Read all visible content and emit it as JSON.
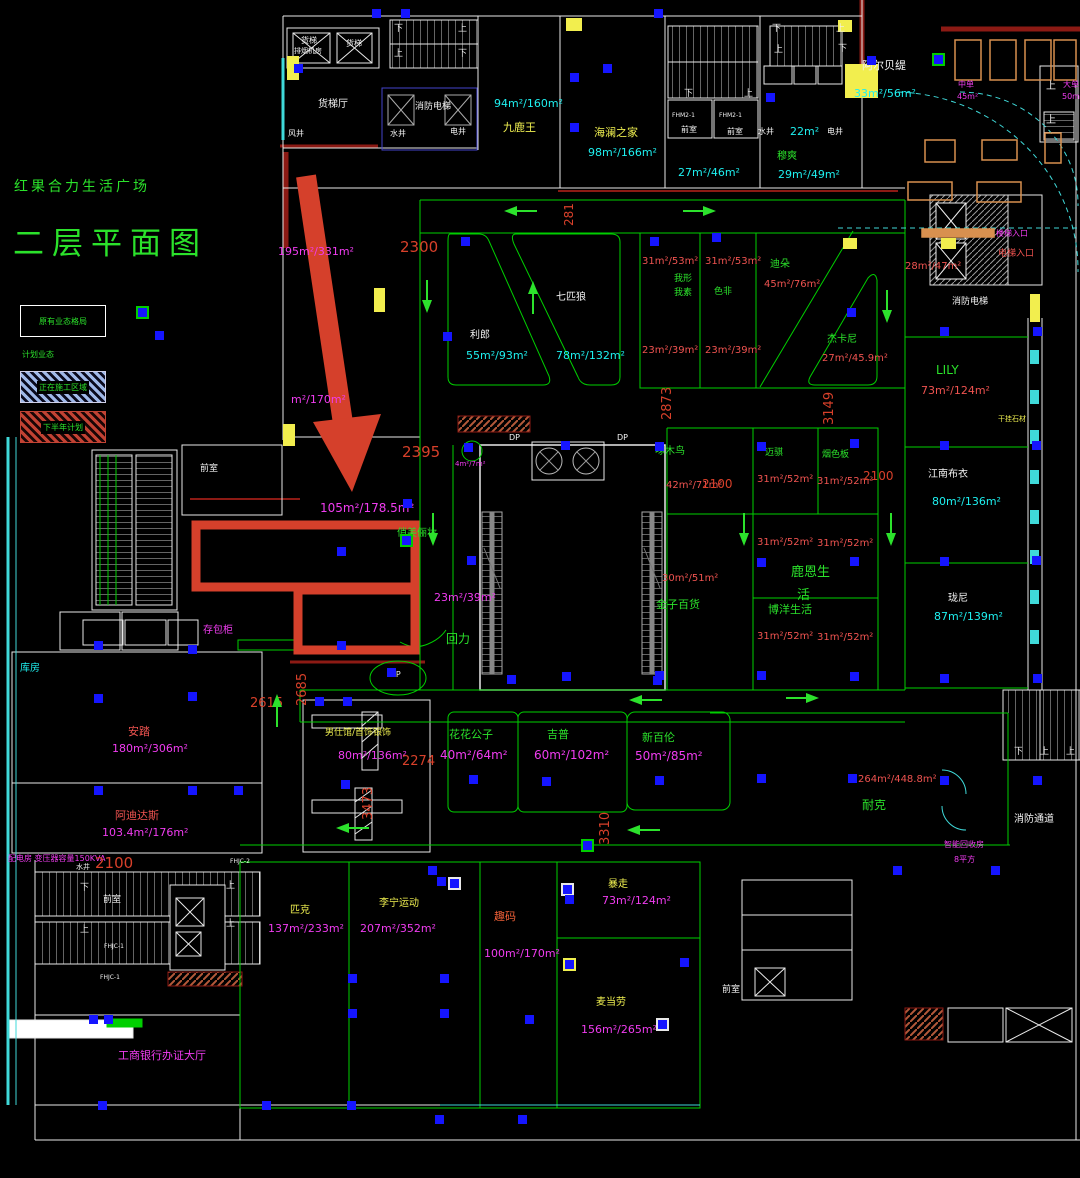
{
  "title": {
    "line1": "红果合力生活广场",
    "line2": "二层平面图"
  },
  "legend": {
    "existing": "原有业态格局",
    "planned": "计划业态",
    "construction": "正在施工区域",
    "second_half": "下半年计划"
  },
  "colors": {
    "g": "#2be22b",
    "c": "#1ef0f0",
    "m": "#f03cf0",
    "r": "#ef5350",
    "y": "#f0f050",
    "w": "#f2f2f2",
    "o": "#f06038",
    "d": "#d8402a"
  },
  "labels": [
    {
      "t": "货梯",
      "x": 301,
      "y": 37,
      "c": "w",
      "s": 8
    },
    {
      "t": "排烟机房",
      "x": 294,
      "y": 48,
      "c": "w",
      "s": 7
    },
    {
      "t": "货梯",
      "x": 346,
      "y": 40,
      "c": "w",
      "s": 8
    },
    {
      "t": "货梯厅",
      "x": 318,
      "y": 100,
      "c": "w",
      "s": 10
    },
    {
      "t": "风井",
      "x": 288,
      "y": 130,
      "c": "w",
      "s": 8
    },
    {
      "t": "水井",
      "x": 390,
      "y": 130,
      "c": "w",
      "s": 8
    },
    {
      "t": "电井",
      "x": 450,
      "y": 128,
      "c": "w",
      "s": 8
    },
    {
      "t": "消防电梯",
      "x": 415,
      "y": 103,
      "c": "w",
      "s": 9
    },
    {
      "t": "下",
      "x": 394,
      "y": 25,
      "c": "w",
      "s": 9
    },
    {
      "t": "上",
      "x": 458,
      "y": 25,
      "c": "w",
      "s": 9
    },
    {
      "t": "上",
      "x": 394,
      "y": 50,
      "c": "w",
      "s": 9
    },
    {
      "t": "下",
      "x": 458,
      "y": 50,
      "c": "w",
      "s": 9
    },
    {
      "t": "94m²/160m²",
      "x": 494,
      "y": 98,
      "c": "c",
      "s": 11
    },
    {
      "t": "九鹿王",
      "x": 503,
      "y": 122,
      "c": "y",
      "s": 11
    },
    {
      "t": "海澜之家",
      "x": 594,
      "y": 127,
      "c": "y",
      "s": 11
    },
    {
      "t": "98m²/166m²",
      "x": 588,
      "y": 147,
      "c": "c",
      "s": 11
    },
    {
      "t": "27m²/46m²",
      "x": 678,
      "y": 167,
      "c": "c",
      "s": 11
    },
    {
      "t": "下",
      "x": 684,
      "y": 90,
      "c": "w",
      "s": 9
    },
    {
      "t": "上",
      "x": 744,
      "y": 90,
      "c": "w",
      "s": 9
    },
    {
      "t": "前室",
      "x": 681,
      "y": 126,
      "c": "w",
      "s": 8
    },
    {
      "t": "前室",
      "x": 727,
      "y": 128,
      "c": "w",
      "s": 8
    },
    {
      "t": "FHM2-1",
      "x": 672,
      "y": 113,
      "c": "w",
      "s": 6
    },
    {
      "t": "FHM2-1",
      "x": 719,
      "y": 113,
      "c": "w",
      "s": 6
    },
    {
      "t": "水井",
      "x": 758,
      "y": 128,
      "c": "w",
      "s": 8
    },
    {
      "t": "22m²",
      "x": 790,
      "y": 126,
      "c": "c",
      "s": 11
    },
    {
      "t": "电井",
      "x": 827,
      "y": 128,
      "c": "w",
      "s": 8
    },
    {
      "t": "下",
      "x": 772,
      "y": 25,
      "c": "w",
      "s": 9
    },
    {
      "t": "上",
      "x": 836,
      "y": 25,
      "c": "w",
      "s": 9
    },
    {
      "t": "上",
      "x": 774,
      "y": 46,
      "c": "w",
      "s": 9
    },
    {
      "t": "下",
      "x": 838,
      "y": 45,
      "c": "w",
      "s": 9
    },
    {
      "t": "穆爽",
      "x": 777,
      "y": 152,
      "c": "g",
      "s": 10
    },
    {
      "t": "29m²/49m²",
      "x": 778,
      "y": 169,
      "c": "c",
      "s": 11
    },
    {
      "t": "阿尔贝缇",
      "x": 862,
      "y": 60,
      "c": "w",
      "s": 11
    },
    {
      "t": "33m²/56m²",
      "x": 854,
      "y": 88,
      "c": "c",
      "s": 11
    },
    {
      "t": "中单",
      "x": 958,
      "y": 81,
      "c": "m",
      "s": 8
    },
    {
      "t": "45m²",
      "x": 957,
      "y": 93,
      "c": "m",
      "s": 8
    },
    {
      "t": "大单",
      "x": 1063,
      "y": 81,
      "c": "m",
      "s": 8
    },
    {
      "t": "50m²",
      "x": 1062,
      "y": 93,
      "c": "m",
      "s": 8
    },
    {
      "t": "上",
      "x": 1046,
      "y": 82,
      "c": "w",
      "s": 10
    },
    {
      "t": "上",
      "x": 1046,
      "y": 116,
      "c": "w",
      "s": 10
    },
    {
      "t": "195m²/331m²",
      "x": 278,
      "y": 246,
      "c": "m",
      "s": 11
    },
    {
      "t": "m²/170m²",
      "x": 291,
      "y": 394,
      "c": "m",
      "s": 11
    },
    {
      "t": "前室",
      "x": 200,
      "y": 465,
      "c": "w",
      "s": 9
    },
    {
      "t": "105m²/178.5m²",
      "x": 320,
      "y": 502,
      "c": "m",
      "s": 12
    },
    {
      "t": "俏美俪妆",
      "x": 397,
      "y": 529,
      "c": "g",
      "s": 10
    },
    {
      "t": "4m²/7m²",
      "x": 455,
      "y": 461,
      "c": "m",
      "s": 7
    },
    {
      "t": "23m²/39m²",
      "x": 434,
      "y": 592,
      "c": "m",
      "s": 11
    },
    {
      "t": "回力",
      "x": 446,
      "y": 633,
      "c": "g",
      "s": 12
    },
    {
      "t": "存包柜",
      "x": 203,
      "y": 626,
      "c": "m",
      "s": 10
    },
    {
      "t": "库房",
      "x": 20,
      "y": 664,
      "c": "c",
      "s": 10
    },
    {
      "t": "安踏",
      "x": 128,
      "y": 726,
      "c": "r",
      "s": 11
    },
    {
      "t": "180m²/306m²",
      "x": 112,
      "y": 743,
      "c": "m",
      "s": 11
    },
    {
      "t": "阿迪达斯",
      "x": 115,
      "y": 810,
      "c": "r",
      "s": 11
    },
    {
      "t": "103.4m²/176m²",
      "x": 102,
      "y": 827,
      "c": "m",
      "s": 11
    },
    {
      "t": "配电房 变压器容量150KVA",
      "x": 8,
      "y": 855,
      "c": "m",
      "s": 8
    },
    {
      "t": "利郎",
      "x": 470,
      "y": 331,
      "c": "w",
      "s": 10
    },
    {
      "t": "55m²/93m²",
      "x": 466,
      "y": 350,
      "c": "c",
      "s": 11
    },
    {
      "t": "七匹狼",
      "x": 556,
      "y": 293,
      "c": "w",
      "s": 10
    },
    {
      "t": "78m²/132m²",
      "x": 556,
      "y": 350,
      "c": "c",
      "s": 11
    },
    {
      "t": "31m²/53m²",
      "x": 642,
      "y": 257,
      "c": "r",
      "s": 10
    },
    {
      "t": "我形",
      "x": 674,
      "y": 275,
      "c": "g",
      "s": 9
    },
    {
      "t": "我素",
      "x": 674,
      "y": 289,
      "c": "g",
      "s": 9
    },
    {
      "t": "23m²/39m²",
      "x": 642,
      "y": 346,
      "c": "r",
      "s": 10
    },
    {
      "t": "31m²/53m²",
      "x": 705,
      "y": 257,
      "c": "r",
      "s": 10
    },
    {
      "t": "色非",
      "x": 714,
      "y": 288,
      "c": "g",
      "s": 9
    },
    {
      "t": "23m²/39m²",
      "x": 705,
      "y": 346,
      "c": "r",
      "s": 10
    },
    {
      "t": "迪朵",
      "x": 770,
      "y": 260,
      "c": "g",
      "s": 10
    },
    {
      "t": "45m²/76m²",
      "x": 764,
      "y": 280,
      "c": "r",
      "s": 10
    },
    {
      "t": "杰卡尼",
      "x": 827,
      "y": 335,
      "c": "g",
      "s": 10
    },
    {
      "t": "27m²/45.9m²",
      "x": 822,
      "y": 354,
      "c": "r",
      "s": 10
    },
    {
      "t": "28m²/47m²",
      "x": 905,
      "y": 262,
      "c": "r",
      "s": 10
    },
    {
      "t": "楼梯入口",
      "x": 996,
      "y": 230,
      "c": "m",
      "s": 8
    },
    {
      "t": "电梯入口",
      "x": 998,
      "y": 250,
      "c": "r",
      "s": 9
    },
    {
      "t": "消防电梯",
      "x": 952,
      "y": 298,
      "c": "w",
      "s": 9
    },
    {
      "t": "干挂石材",
      "x": 998,
      "y": 416,
      "c": "y",
      "s": 7
    },
    {
      "t": "LILY",
      "x": 936,
      "y": 364,
      "c": "g",
      "s": 12
    },
    {
      "t": "73m²/124m²",
      "x": 921,
      "y": 385,
      "c": "r",
      "s": 11
    },
    {
      "t": "江南布衣",
      "x": 928,
      "y": 470,
      "c": "w",
      "s": 10
    },
    {
      "t": "80m²/136m²",
      "x": 932,
      "y": 496,
      "c": "c",
      "s": 11
    },
    {
      "t": "珑尼",
      "x": 948,
      "y": 594,
      "c": "w",
      "s": 10
    },
    {
      "t": "87m²/139m²",
      "x": 934,
      "y": 611,
      "c": "c",
      "s": 11
    },
    {
      "t": "DP",
      "x": 509,
      "y": 434,
      "c": "w",
      "s": 8
    },
    {
      "t": "DP",
      "x": 617,
      "y": 434,
      "c": "w",
      "s": 8
    },
    {
      "t": "啄木鸟",
      "x": 655,
      "y": 447,
      "c": "g",
      "s": 10
    },
    {
      "t": "42m²/71m²",
      "x": 666,
      "y": 481,
      "c": "r",
      "s": 10
    },
    {
      "t": "30m²/51m²",
      "x": 662,
      "y": 574,
      "c": "r",
      "s": 10
    },
    {
      "t": "金子百货",
      "x": 656,
      "y": 599,
      "c": "g",
      "s": 11
    },
    {
      "t": "迈骐",
      "x": 765,
      "y": 449,
      "c": "g",
      "s": 9
    },
    {
      "t": "31m²/52m²",
      "x": 757,
      "y": 475,
      "c": "r",
      "s": 10
    },
    {
      "t": "烟色板",
      "x": 822,
      "y": 451,
      "c": "g",
      "s": 9
    },
    {
      "t": "31m²/52m²",
      "x": 817,
      "y": 477,
      "c": "r",
      "s": 10
    },
    {
      "t": "31m²/52m²",
      "x": 757,
      "y": 538,
      "c": "r",
      "s": 10
    },
    {
      "t": "31m²/52m²",
      "x": 817,
      "y": 539,
      "c": "r",
      "s": 10
    },
    {
      "t": "鹿恩生",
      "x": 791,
      "y": 566,
      "c": "g",
      "s": 13
    },
    {
      "t": "活",
      "x": 797,
      "y": 589,
      "c": "g",
      "s": 13
    },
    {
      "t": "博洋生活",
      "x": 768,
      "y": 604,
      "c": "g",
      "s": 11
    },
    {
      "t": "31m²/52m²",
      "x": 757,
      "y": 632,
      "c": "r",
      "s": 10
    },
    {
      "t": "31m²/52m²",
      "x": 817,
      "y": 633,
      "c": "r",
      "s": 10
    },
    {
      "t": "UP",
      "x": 390,
      "y": 671,
      "c": "w",
      "s": 8
    },
    {
      "t": "男仕馆/首饰银饰",
      "x": 325,
      "y": 729,
      "c": "y",
      "s": 9
    },
    {
      "t": "80m²/136m²",
      "x": 338,
      "y": 750,
      "c": "m",
      "s": 11
    },
    {
      "t": "花花公子",
      "x": 449,
      "y": 729,
      "c": "g",
      "s": 11
    },
    {
      "t": "40m²/64m²",
      "x": 440,
      "y": 749,
      "c": "m",
      "s": 12
    },
    {
      "t": "吉普",
      "x": 547,
      "y": 729,
      "c": "g",
      "s": 11
    },
    {
      "t": "60m²/102m²",
      "x": 534,
      "y": 749,
      "c": "m",
      "s": 12
    },
    {
      "t": "新百伦",
      "x": 642,
      "y": 732,
      "c": "g",
      "s": 11
    },
    {
      "t": "50m²/85m²",
      "x": 635,
      "y": 750,
      "c": "m",
      "s": 12
    },
    {
      "t": "264m²/448.8m²",
      "x": 858,
      "y": 775,
      "c": "r",
      "s": 10
    },
    {
      "t": "耐克",
      "x": 862,
      "y": 799,
      "c": "g",
      "s": 12
    },
    {
      "t": "下",
      "x": 1014,
      "y": 748,
      "c": "w",
      "s": 9
    },
    {
      "t": "上",
      "x": 1040,
      "y": 748,
      "c": "w",
      "s": 9
    },
    {
      "t": "上",
      "x": 1066,
      "y": 748,
      "c": "w",
      "s": 9
    },
    {
      "t": "消防通道",
      "x": 1014,
      "y": 815,
      "c": "w",
      "s": 10
    },
    {
      "t": "智能回收房",
      "x": 944,
      "y": 841,
      "c": "m",
      "s": 8
    },
    {
      "t": "8平方",
      "x": 954,
      "y": 856,
      "c": "m",
      "s": 8
    },
    {
      "t": "匹克",
      "x": 290,
      "y": 906,
      "c": "y",
      "s": 10
    },
    {
      "t": "137m²/233m²",
      "x": 268,
      "y": 923,
      "c": "m",
      "s": 11
    },
    {
      "t": "李宁运动",
      "x": 379,
      "y": 899,
      "c": "y",
      "s": 10
    },
    {
      "t": "207m²/352m²",
      "x": 360,
      "y": 923,
      "c": "m",
      "s": 11
    },
    {
      "t": "趣码",
      "x": 494,
      "y": 911,
      "c": "o",
      "s": 11
    },
    {
      "t": "100m²/170m²",
      "x": 484,
      "y": 948,
      "c": "m",
      "s": 11
    },
    {
      "t": "暴走",
      "x": 608,
      "y": 880,
      "c": "y",
      "s": 10
    },
    {
      "t": "73m²/124m²",
      "x": 602,
      "y": 895,
      "c": "m",
      "s": 11
    },
    {
      "t": "麦当劳",
      "x": 596,
      "y": 998,
      "c": "y",
      "s": 10
    },
    {
      "t": "156m²/265m²",
      "x": 581,
      "y": 1024,
      "c": "m",
      "s": 11
    },
    {
      "t": "工商银行办证大厅",
      "x": 118,
      "y": 1050,
      "c": "m",
      "s": 11
    },
    {
      "t": "前室",
      "x": 103,
      "y": 896,
      "c": "w",
      "s": 9
    },
    {
      "t": "水井",
      "x": 76,
      "y": 864,
      "c": "w",
      "s": 7
    },
    {
      "t": "FHJC-1",
      "x": 104,
      "y": 944,
      "c": "w",
      "s": 6
    },
    {
      "t": "FHJC-1",
      "x": 100,
      "y": 975,
      "c": "w",
      "s": 6
    },
    {
      "t": "FHJC-2",
      "x": 230,
      "y": 859,
      "c": "w",
      "s": 6
    },
    {
      "t": "下",
      "x": 80,
      "y": 884,
      "c": "w",
      "s": 9
    },
    {
      "t": "上",
      "x": 80,
      "y": 926,
      "c": "w",
      "s": 9
    },
    {
      "t": "上",
      "x": 226,
      "y": 882,
      "c": "w",
      "s": 9
    },
    {
      "t": "上",
      "x": 226,
      "y": 920,
      "c": "w",
      "s": 9
    },
    {
      "t": "前室",
      "x": 722,
      "y": 986,
      "c": "w",
      "s": 9
    },
    {
      "t": "2300",
      "x": 400,
      "y": 240,
      "c": "d",
      "s": 15
    },
    {
      "t": "2395",
      "x": 402,
      "y": 445,
      "c": "d",
      "s": 15
    },
    {
      "t": "2615",
      "x": 250,
      "y": 697,
      "c": "d",
      "s": 13
    },
    {
      "t": "2685",
      "x": 296,
      "y": 706,
      "c": "d",
      "s": 13,
      "r": -90
    },
    {
      "t": "2274",
      "x": 402,
      "y": 755,
      "c": "d",
      "s": 13
    },
    {
      "t": "2873",
      "x": 661,
      "y": 420,
      "c": "d",
      "s": 13,
      "r": -90
    },
    {
      "t": "3149",
      "x": 823,
      "y": 425,
      "c": "d",
      "s": 13,
      "r": -90
    },
    {
      "t": "2100",
      "x": 702,
      "y": 478,
      "c": "d",
      "s": 12
    },
    {
      "t": "2100",
      "x": 863,
      "y": 470,
      "c": "d",
      "s": 12
    },
    {
      "t": "3473",
      "x": 362,
      "y": 820,
      "c": "d",
      "s": 13,
      "r": -90
    },
    {
      "t": "3310",
      "x": 599,
      "y": 845,
      "c": "d",
      "s": 13,
      "r": -90
    },
    {
      "t": "2100",
      "x": 95,
      "y": 856,
      "c": "d",
      "s": 15
    },
    {
      "t": "281",
      "x": 563,
      "y": 226,
      "c": "d",
      "s": 12,
      "r": -90
    }
  ],
  "squares": [
    [
      377,
      14
    ],
    [
      406,
      14
    ],
    [
      659,
      14
    ],
    [
      299,
      69
    ],
    [
      575,
      78
    ],
    [
      608,
      69
    ],
    [
      872,
      61
    ],
    [
      771,
      98
    ],
    [
      575,
      128
    ],
    [
      937,
      58,
      "g"
    ],
    [
      566,
      446
    ],
    [
      469,
      448
    ],
    [
      466,
      242
    ],
    [
      655,
      242
    ],
    [
      717,
      238
    ],
    [
      852,
      313
    ],
    [
      448,
      337
    ],
    [
      160,
      336
    ],
    [
      141,
      311,
      "g"
    ],
    [
      342,
      552
    ],
    [
      405,
      539,
      "g"
    ],
    [
      408,
      504
    ],
    [
      342,
      646
    ],
    [
      472,
      561
    ],
    [
      660,
      447
    ],
    [
      660,
      676
    ],
    [
      567,
      677
    ],
    [
      762,
      447
    ],
    [
      855,
      444
    ],
    [
      762,
      563
    ],
    [
      855,
      562
    ],
    [
      762,
      676
    ],
    [
      855,
      677
    ],
    [
      945,
      332
    ],
    [
      1038,
      332
    ],
    [
      945,
      446
    ],
    [
      1037,
      446
    ],
    [
      945,
      562
    ],
    [
      1037,
      561
    ],
    [
      99,
      646
    ],
    [
      193,
      650
    ],
    [
      99,
      699
    ],
    [
      193,
      697
    ],
    [
      99,
      791
    ],
    [
      193,
      791
    ],
    [
      239,
      791
    ],
    [
      320,
      702
    ],
    [
      348,
      702
    ],
    [
      346,
      785
    ],
    [
      474,
      780
    ],
    [
      547,
      782
    ],
    [
      658,
      681
    ],
    [
      512,
      680
    ],
    [
      660,
      781
    ],
    [
      762,
      779
    ],
    [
      853,
      779
    ],
    [
      433,
      871
    ],
    [
      442,
      882
    ],
    [
      453,
      882,
      "w"
    ],
    [
      353,
      979
    ],
    [
      445,
      979
    ],
    [
      353,
      1014
    ],
    [
      445,
      1014
    ],
    [
      566,
      888,
      "w"
    ],
    [
      570,
      900
    ],
    [
      568,
      963,
      "y"
    ],
    [
      685,
      963
    ],
    [
      530,
      1020
    ],
    [
      661,
      1023,
      "w"
    ],
    [
      945,
      679
    ],
    [
      1038,
      679
    ],
    [
      945,
      781
    ],
    [
      1038,
      781
    ],
    [
      898,
      871
    ],
    [
      996,
      871
    ],
    [
      94,
      1020
    ],
    [
      109,
      1020
    ],
    [
      392,
      673
    ],
    [
      586,
      844,
      "g"
    ],
    [
      103,
      1106
    ],
    [
      267,
      1106
    ],
    [
      352,
      1106
    ],
    [
      440,
      1120
    ],
    [
      523,
      1120
    ]
  ],
  "arrows": [
    [
      520,
      211,
      "left"
    ],
    [
      700,
      211,
      "right"
    ],
    [
      533,
      297,
      "up"
    ],
    [
      427,
      297,
      "down"
    ],
    [
      433,
      530,
      "down"
    ],
    [
      744,
      530,
      "down"
    ],
    [
      891,
      530,
      "down"
    ],
    [
      887,
      307,
      "down"
    ],
    [
      277,
      710,
      "up"
    ],
    [
      352,
      828,
      "left"
    ],
    [
      645,
      700,
      "left"
    ],
    [
      803,
      698,
      "right"
    ],
    [
      643,
      830,
      "left"
    ]
  ]
}
